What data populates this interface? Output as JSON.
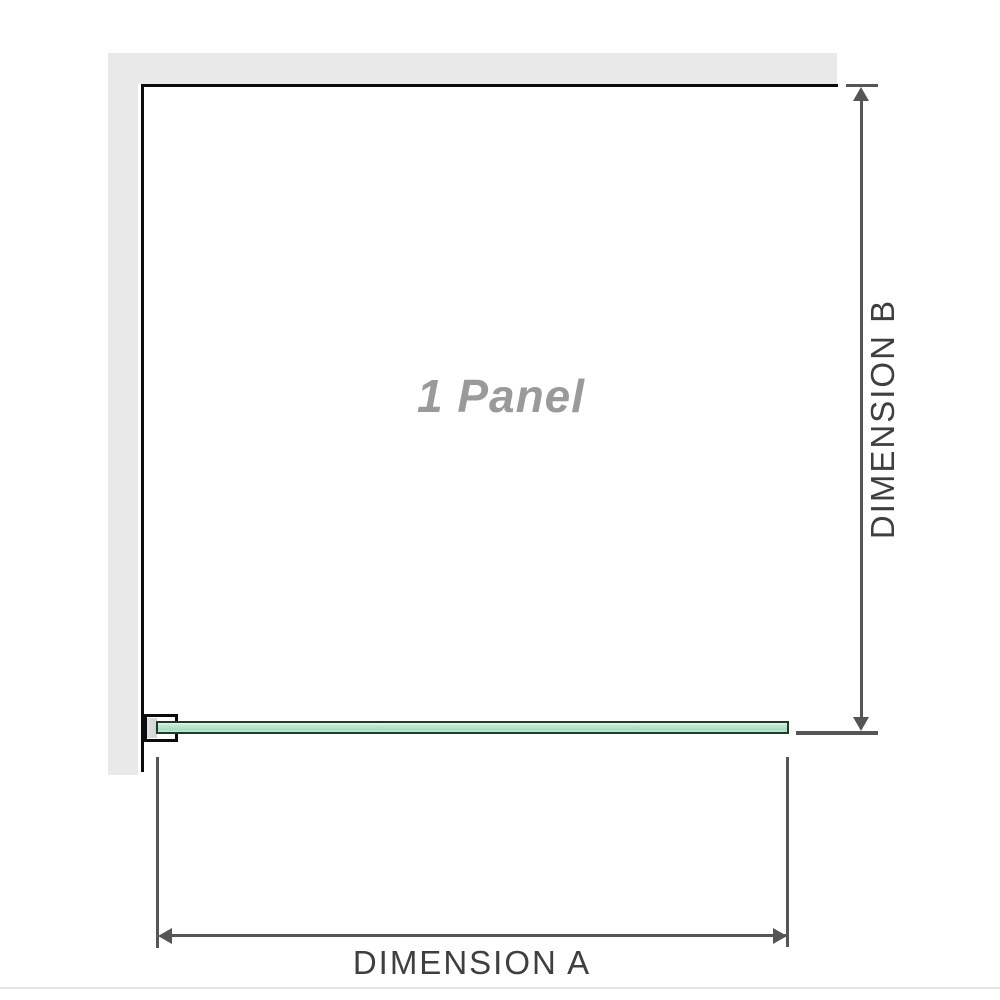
{
  "diagram": {
    "title": "1 Panel shower screen installation diagram (top view)",
    "panel_label": "1 Panel",
    "dimension_a_label": "DIMENSION A",
    "dimension_b_label": "DIMENSION B"
  },
  "icons": {
    "arrows": [
      "arrow-up-icon",
      "arrow-down-icon",
      "arrow-left-icon",
      "arrow-right-icon"
    ]
  },
  "colors": {
    "background": "#ffffff",
    "wall_fill": "#e9e9e9",
    "enclosure_outline": "#0c0c0c",
    "glass_fill": "#a6dcc2",
    "glass_border": "#1e3b2c",
    "bracket_outline": "#0b0b0b",
    "bracket_pad_fill": "#d9d9d9",
    "dimension_line": "#555555",
    "dimension_text": "#3f3f3f",
    "panel_text": "#9a9a9a",
    "divider": "#e3e3e3"
  }
}
